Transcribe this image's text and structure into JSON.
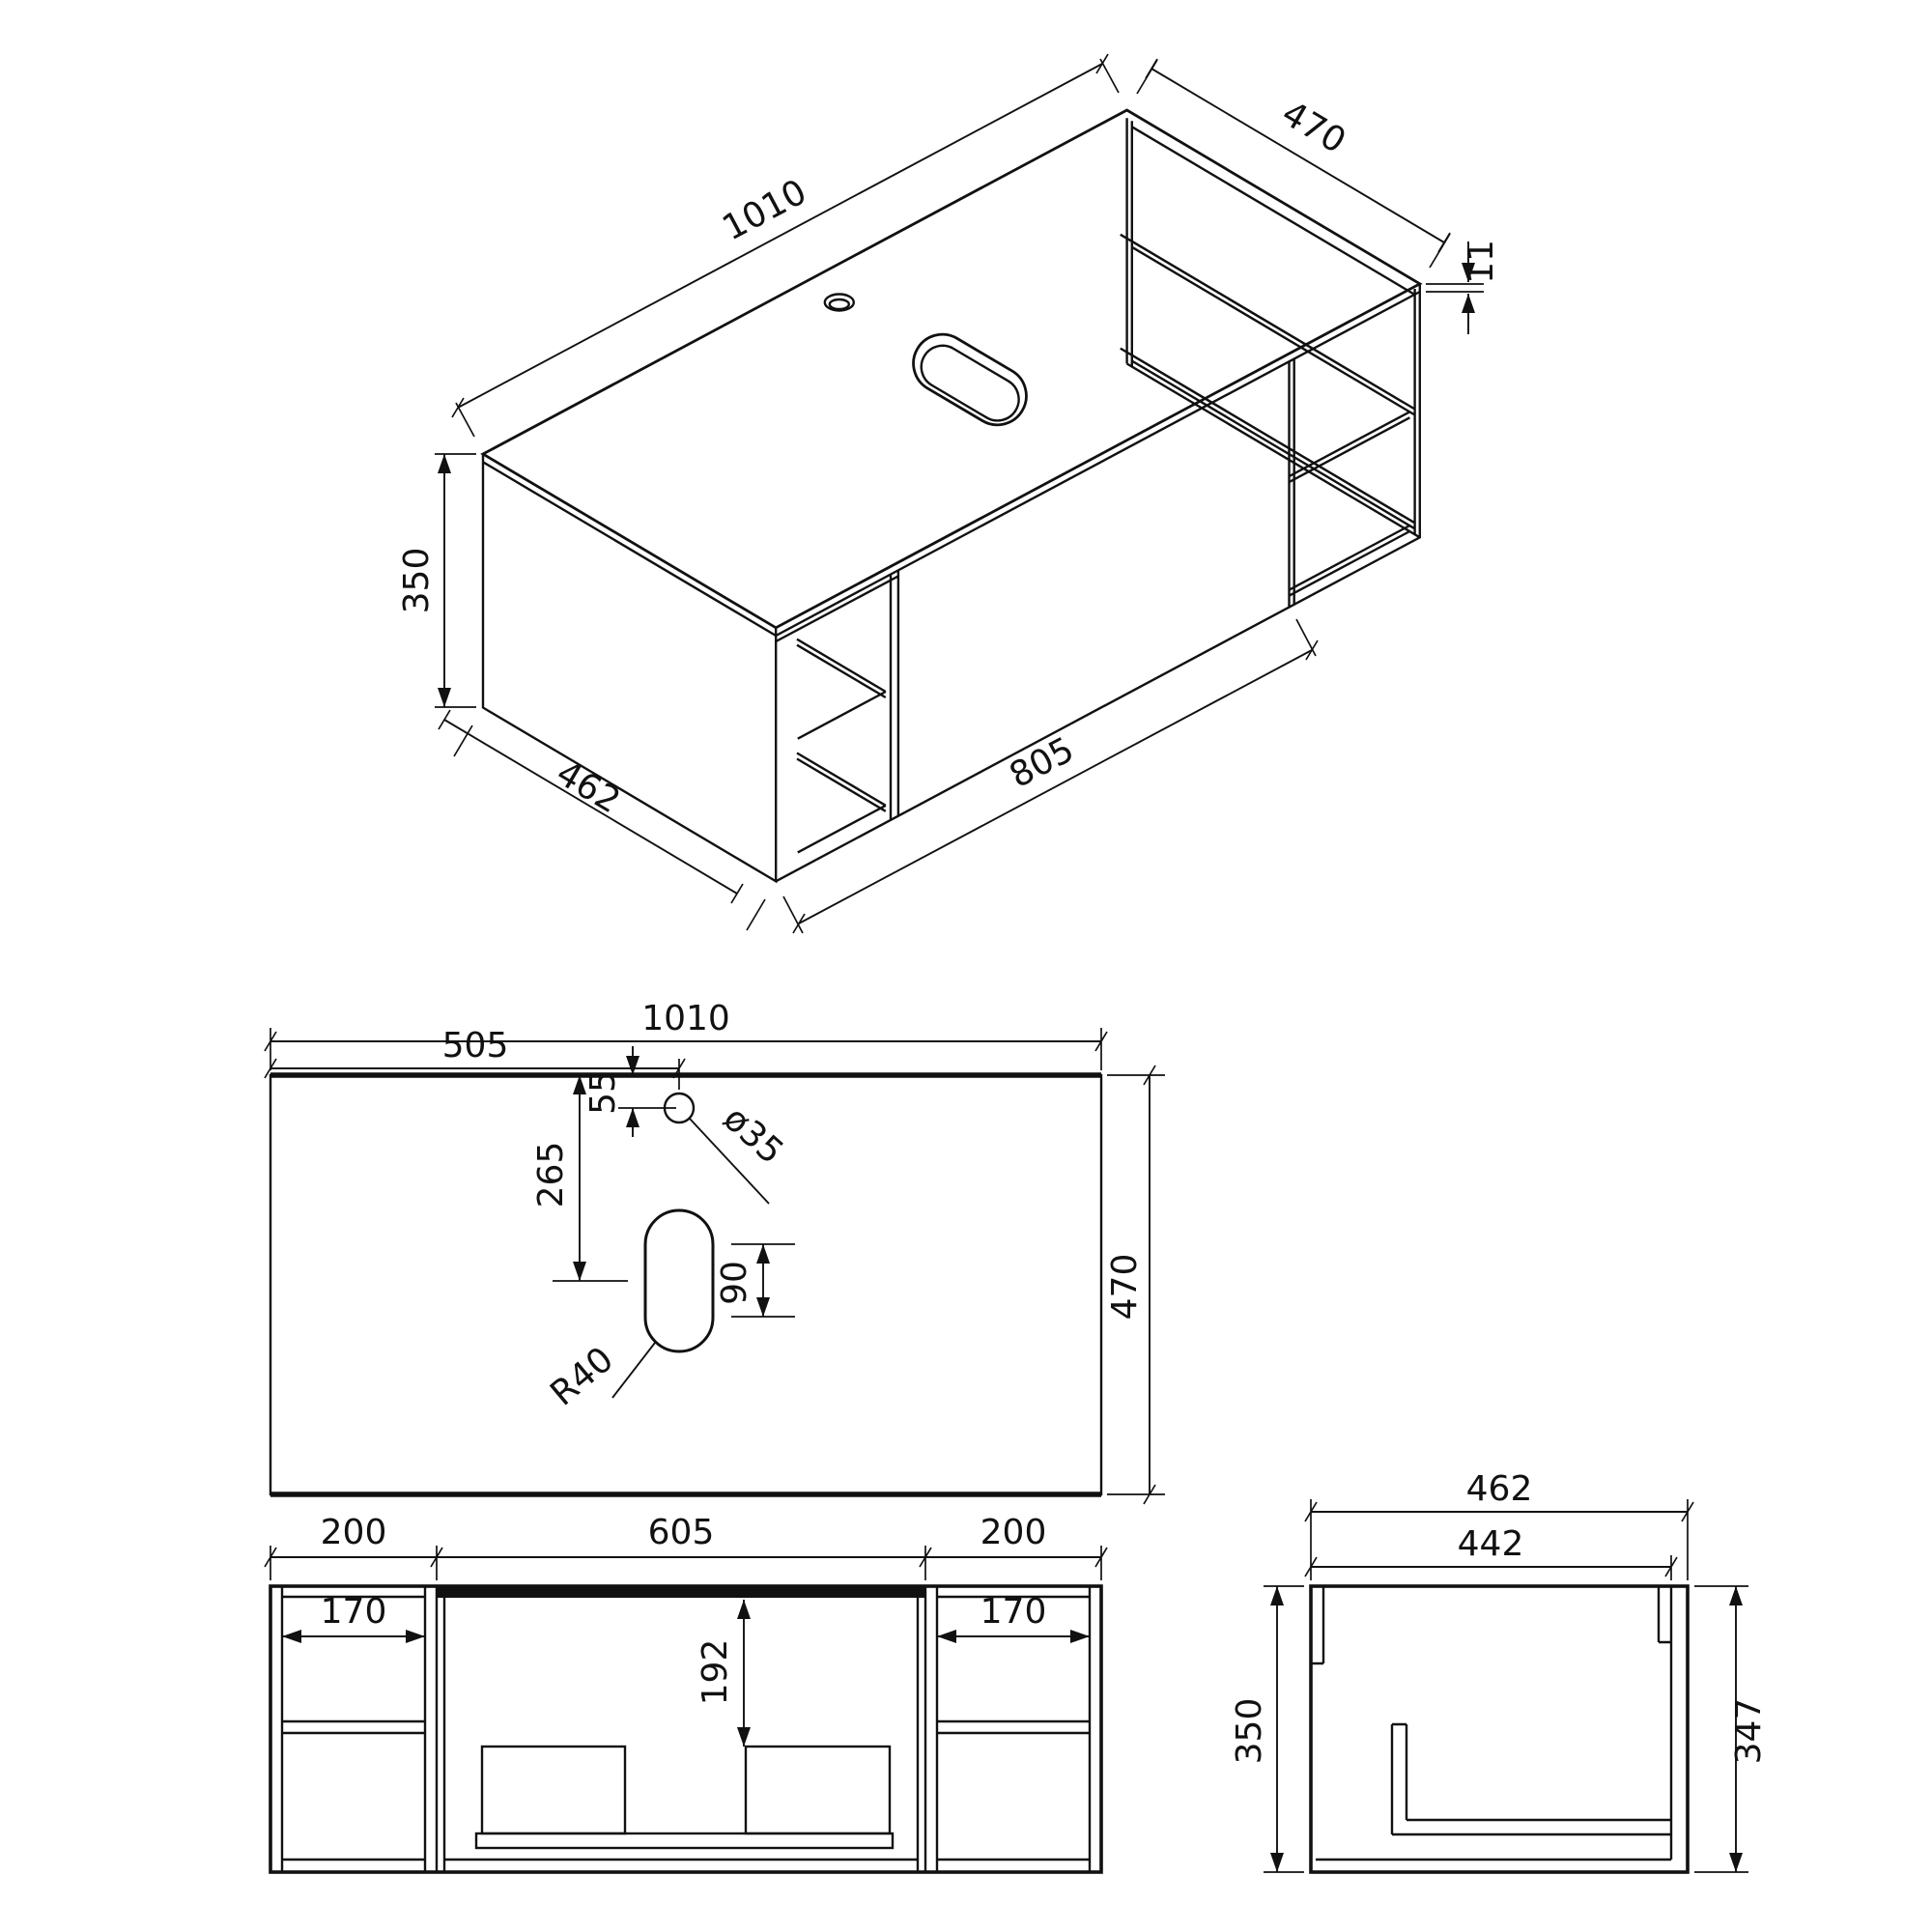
{
  "page": {
    "background": "#ffffff",
    "line_color": "#111111",
    "drawing_type": "technical-drawing"
  },
  "views": {
    "isometric": {
      "dims": {
        "length": "1010",
        "depth": "470",
        "top_thickness": "11",
        "height": "350",
        "bottom_depth": "462",
        "front_width": "805"
      }
    },
    "plan": {
      "dims": {
        "width": "1010",
        "faucet_center_x": "505",
        "faucet_offset_y": "55",
        "faucet_diameter": "ø35",
        "drain_center_y": "265",
        "drain_slot_length": "90",
        "drain_radius": "R40",
        "depth": "470"
      }
    },
    "front": {
      "dims": {
        "left_section": "200",
        "middle_section": "605",
        "right_section": "200",
        "left_shelf_width": "170",
        "right_shelf_width": "170",
        "drawer_clearance": "192"
      }
    },
    "side": {
      "dims": {
        "outer_depth": "462",
        "inner_depth": "442",
        "height": "350",
        "inner_height": "347"
      }
    }
  }
}
